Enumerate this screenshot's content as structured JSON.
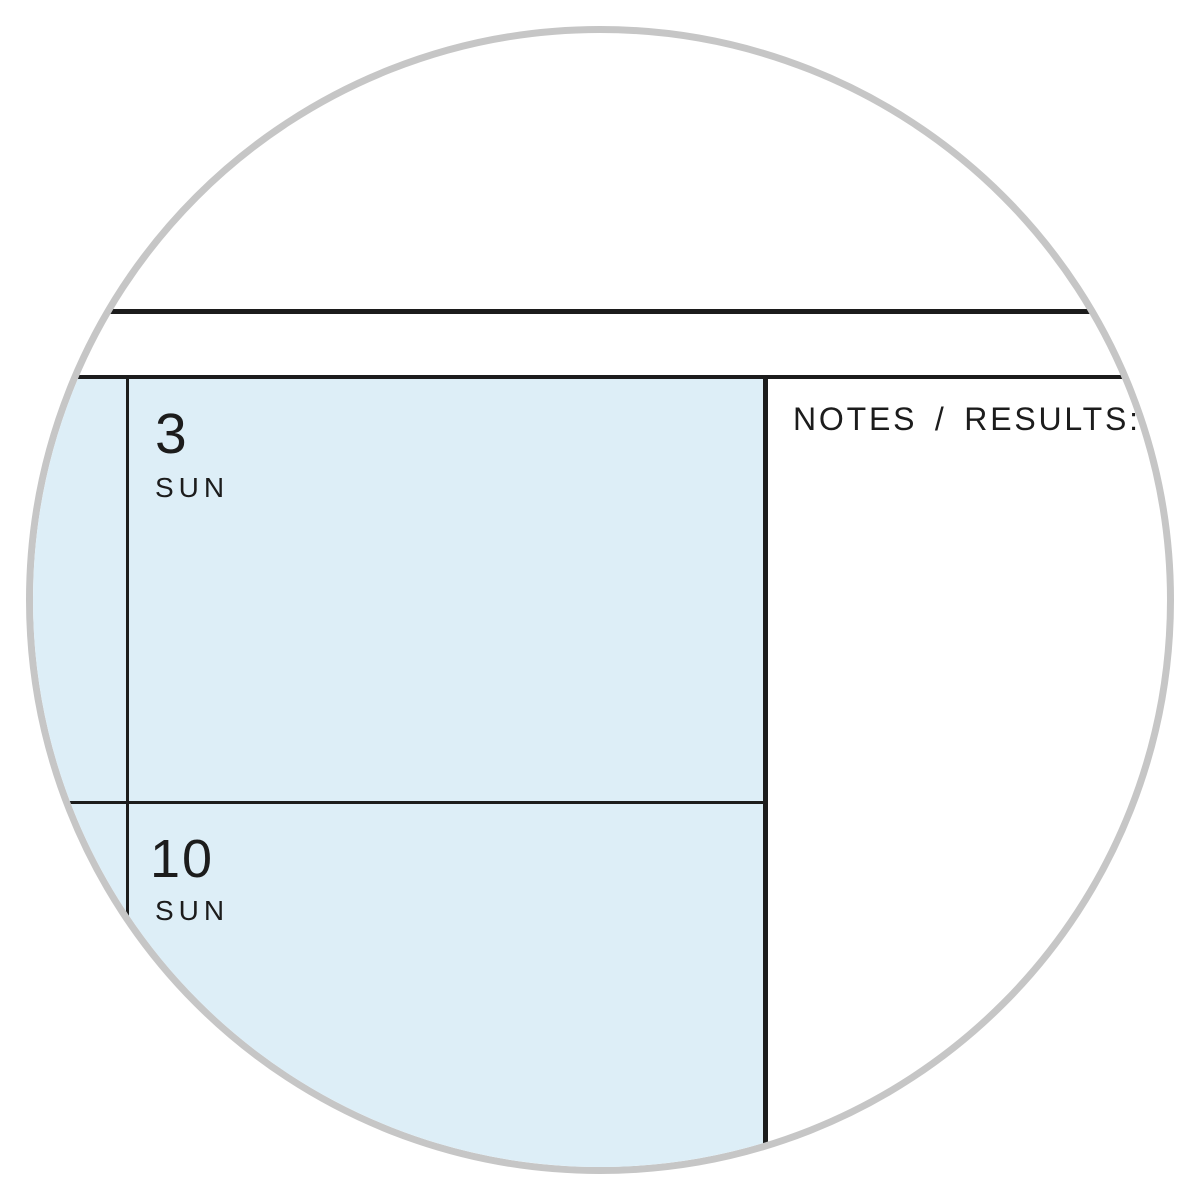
{
  "planner": {
    "days": [
      {
        "date": "3",
        "weekday": "SUN"
      },
      {
        "date": "10",
        "weekday": "SUN"
      }
    ],
    "notes_header": "NOTES / RESULTS:"
  },
  "colors": {
    "cell_fill": "#ddeef7",
    "grid_line": "#1c1c1c",
    "text": "#1c1c1c",
    "circle_border": "#c6c6c6",
    "background": "#ffffff"
  }
}
